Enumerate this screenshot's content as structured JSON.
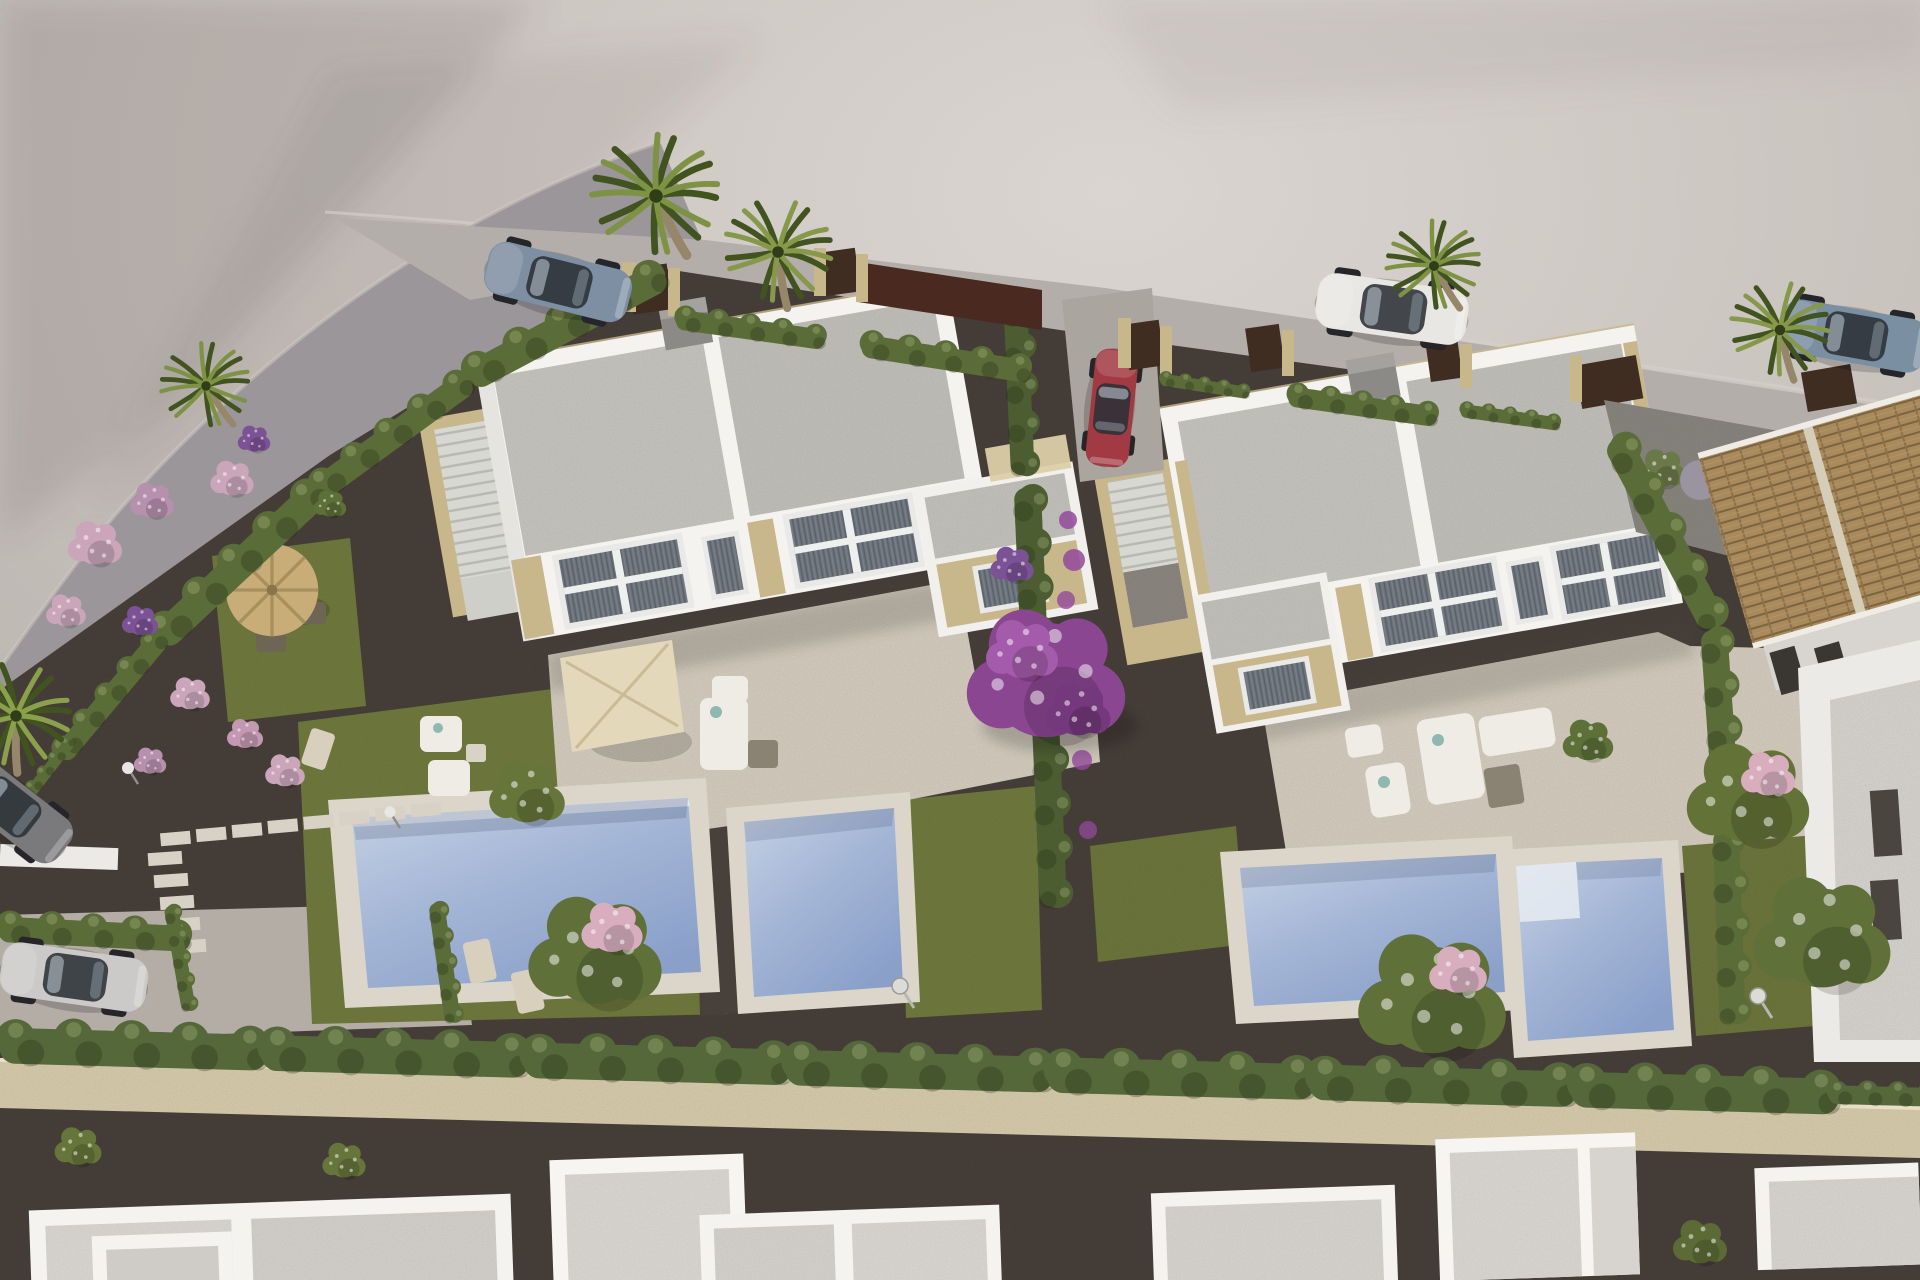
{
  "meta": {
    "type": "architectural-3d-render",
    "view": "aerial-oblique",
    "subject": "New-build residential development: two white duplex villas with roof terraces, private pools and gardens, surrounded by hedges, palms, parked cars and neighbouring houses"
  },
  "palette": {
    "ground": "#c7c1bc",
    "ground_light": "#d9d4cf",
    "road": "#9b969a",
    "curb": "#d4cfca",
    "street": "#b4aeab",
    "driveway": "#aba59f",
    "parking": "#b3ada6",
    "gravel": "#48403a",
    "gravel_mid": "#6b635a",
    "gravel_light": "#8d8881",
    "lawn": "#717b3e",
    "lawn_dark": "#566330",
    "hedge": "#5a6c38",
    "hedge_dark": "#3e4f28",
    "cypress": "#4c5e31",
    "palm": "#7d9242",
    "palm_dark": "#41541f",
    "trunk": "#97876a",
    "pool_water": "#a9bad9",
    "pool_deep": "#8ba3cc",
    "pool_apron": "#dcd6ca",
    "terrace": "#d6cec0",
    "villa_white": "#f4f3f0",
    "villa_shade": "#dddbd6",
    "roof": "#c9c7c2",
    "roof_shade": "#b2b0ab",
    "stone": "#c9b78c",
    "stone_light": "#dccda6",
    "window_frame": "#e9e9e7",
    "blinds": "#6d737b",
    "blinds_dark": "#585f68",
    "fence_brown": "#3f2d22",
    "fence_maroon": "#4a2a20",
    "wall_stone": "#d9cdae",
    "tile_roof": "#a98a5c",
    "tile_dark": "#7c6440",
    "bougainvillea": "#94499b",
    "flower_pink": "#cba6bb",
    "flower_purple": "#7c5296",
    "blossom": "#d8aebf",
    "car_blue": "#7e8fa4",
    "car_red": "#a23a43",
    "car_white": "#e9e7e3",
    "car_suv": "#7b8fa3",
    "car_silver": "#cbcac8",
    "car_gray": "#7a797c",
    "furniture": "#efece5",
    "parasol_straw": "#c8ad79",
    "parasol_cream": "#e4d8ba",
    "chimney": "#8b8a86",
    "steps": "#d8d8d3"
  },
  "scene": {
    "plots": {
      "left_villa": "white duplex villa, flat gravel roof, external stair to roof terrace, stone accents, two gardens with one large and one small pool",
      "right_villa": "matching white duplex villa with external stair, terrace furniture, two pools and lawns",
      "central_driveway": "gravel alley between plots lined with a cypress hedge and climbing bougainvillea"
    },
    "surroundings": {
      "access_road": "curved asphalt road along the left edge",
      "rear_street": "paved street behind the villas with parked cars",
      "perimeter_wall": "beige natural-stone wall with continuous hedge along the bottom of the site",
      "rear_path": "dark gravel path below the wall",
      "bottom_buildings": "row of neighbouring white flat-roof buildings",
      "tiled_house": "neighbouring house with terracotta tiled hip roof at right edge"
    },
    "vehicles": [
      {
        "id": "sports-car",
        "desc": "blue-grey sports car on access road (top left)"
      },
      {
        "id": "white-car",
        "desc": "white car parked on rear street behind right villa"
      },
      {
        "id": "red-car",
        "desc": "red car parked at top of central driveway"
      },
      {
        "id": "suv-car",
        "desc": "blue-grey SUV on rear street (top right)"
      },
      {
        "id": "silver-car",
        "desc": "silver hatchback in side parking (bottom left)"
      },
      {
        "id": "gray-car",
        "desc": "grey car partially visible at left edge"
      }
    ],
    "vegetation": [
      "fan palms",
      "clipped hedges",
      "cypress screen",
      "purple bougainvillea",
      "pink flowering shrubs",
      "fruit trees with pink blossom",
      "lawns"
    ],
    "props": [
      "straw parasol with bistro set",
      "cream square parasol with dining set",
      "white lounge furniture",
      "deck chairs",
      "stepping-stone paths",
      "outdoor showers",
      "garden lamps",
      "roof chimneys"
    ]
  }
}
